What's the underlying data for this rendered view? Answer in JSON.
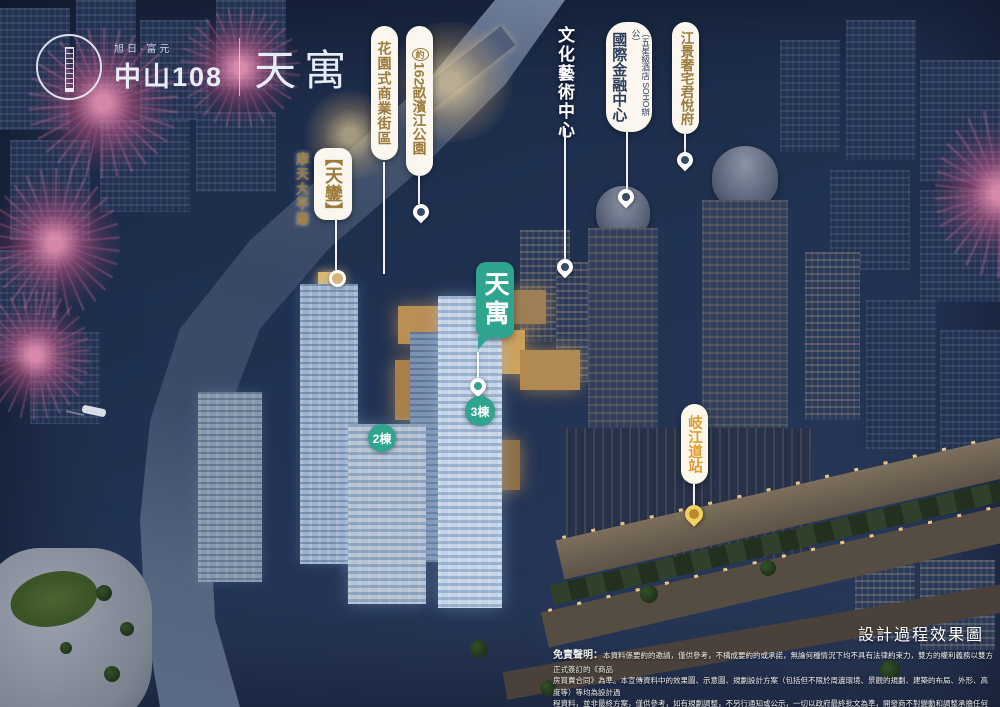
{
  "logo": {
    "brand_small": "旭日·富元",
    "brand_main": "中山108",
    "brand_product": "天寓"
  },
  "callouts": {
    "tianluan": {
      "side_label": "摩天大平層",
      "label": "【天鑾】"
    },
    "garden_street": {
      "label": "花園式商業街區"
    },
    "riverside_park": {
      "prefix": "約",
      "number": "162",
      "suffix": "畝濱江公園"
    },
    "culture_center": {
      "label": "文化藝術中心"
    },
    "financial_center": {
      "label": "國際金融中心",
      "side_label": "（五星級酒店 SOHO辦公）"
    },
    "riverview_mansion": {
      "label": "江景奢宅君悅府"
    },
    "metro_station": {
      "label": "岐江道站"
    },
    "tianyu_badge": {
      "label": "天寓"
    }
  },
  "building_markers": {
    "tower2": "2棟",
    "tower3": "3棟"
  },
  "footer": {
    "render_note": "設計過程效果圖",
    "disclaimer_title": "免責聲明：",
    "disclaimer_lines": [
      "本資料係要約的邀請，僅供參考，不構成要約的或承諾，無論何種情況下均不具有法律約束力，雙方的權利義務以雙方正式簽訂的《商品",
      "房買賣合同》為準。本宣傳資料中的效果圖、示意圖、規劃設計方案（包括但不限於周邊環境、景觀的規劃、建築的布局、外形、高度等）等均為設計過",
      "程資料，並非最終方案，僅供參考，如有規劃調整，不另行通知或公示，一切以政府最終批文為準，開發商不對變動和調整承擔任何責任。"
    ]
  },
  "colors": {
    "accent_teal": "#2fa48e",
    "label_gold": "#9c7b3c",
    "label_navy": "#2c3e5c",
    "bubble_bg": "#fbf7ee",
    "pin_yellow": "#f2d05e",
    "night_sky": "#1e2f4e"
  }
}
